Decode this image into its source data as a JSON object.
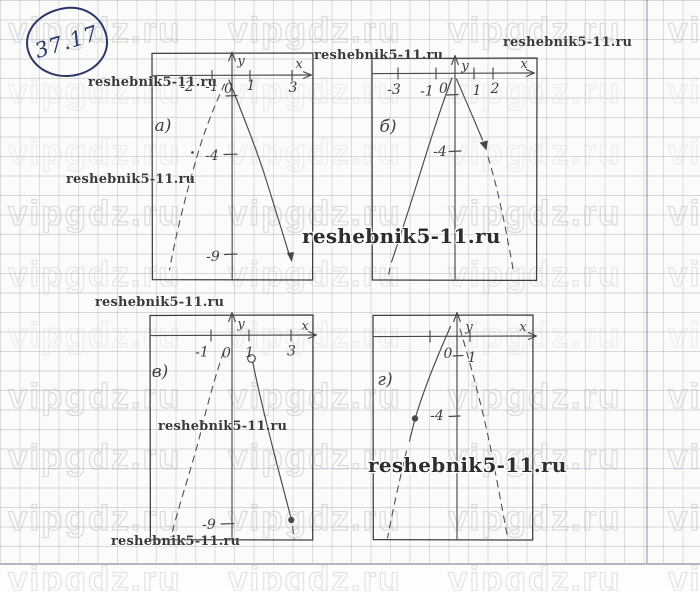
{
  "page": {
    "problem_number": "37.17"
  },
  "watermarks": {
    "tile_text": "vipgdz.ru",
    "site_text": "reshebnik5-11.ru"
  },
  "graphs": {
    "a": {
      "label": "а)",
      "axis_x": "x",
      "axis_y": "y",
      "x_ticks": [
        "-2",
        "-1",
        "0",
        "1",
        "3"
      ],
      "y_ticks": [
        "-4",
        "-9"
      ]
    },
    "b": {
      "label": "б)",
      "axis_x": "x",
      "axis_y": "y",
      "x_ticks": [
        "-3",
        "-1",
        "0",
        "1",
        "2"
      ],
      "y_ticks": [
        "-4"
      ]
    },
    "v": {
      "label": "в)",
      "axis_x": "x",
      "axis_y": "y",
      "x_ticks": [
        "-1",
        "0",
        "1",
        "3"
      ],
      "y_ticks": [
        "-9"
      ]
    },
    "g": {
      "label": "г)",
      "axis_x": "x",
      "axis_y": "y",
      "x_ticks": [
        "0",
        "1"
      ],
      "y_ticks": [
        "-4"
      ]
    }
  },
  "chart_data": [
    {
      "type": "line",
      "panel": "а)",
      "title": "",
      "x_tick_labels": [
        -2,
        -1,
        0,
        1,
        3
      ],
      "y_tick_labels": [
        -4,
        -9
      ],
      "curve": "downward parabola sketch, vertex near origin",
      "left_branch": "dashed",
      "right_branch": "solid with arrowhead ending near (3,-9)"
    },
    {
      "type": "line",
      "panel": "б)",
      "title": "",
      "x_tick_labels": [
        -3,
        -1,
        0,
        1,
        2
      ],
      "y_tick_labels": [
        -4
      ],
      "curve": "downward parabola sketch, vertex near origin",
      "left_branch": "solid",
      "right_branch": "dashed with arrowhead"
    },
    {
      "type": "line",
      "panel": "в)",
      "title": "",
      "x_tick_labels": [
        -1,
        0,
        1,
        3
      ],
      "y_tick_labels": [
        -9
      ],
      "curve": "downward parabola sketch",
      "left_branch": "dashed",
      "right_branch": "solid from open point (1,-1) to filled point (3,-9)"
    },
    {
      "type": "line",
      "panel": "г)",
      "title": "",
      "x_tick_labels": [
        0,
        1
      ],
      "y_tick_labels": [
        -4
      ],
      "curve": "downward parabola sketch, vertex near origin",
      "left_branch": "solid through filled point (-2,-4)",
      "right_branch": "dashed"
    }
  ]
}
